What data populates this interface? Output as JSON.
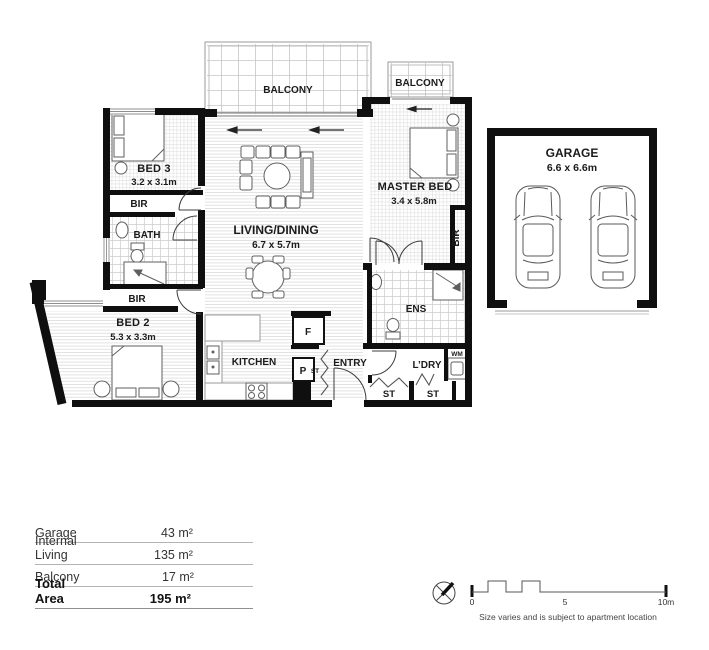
{
  "plan": {
    "balcony_main": {
      "label": "BALCONY"
    },
    "balcony_small": {
      "label": "BALCONY"
    },
    "bed3": {
      "label": "BED 3",
      "dims": "3.2 x 3.1m"
    },
    "bir_bed3": {
      "label": "BIR"
    },
    "bath": {
      "label": "BATH"
    },
    "bir_bed2": {
      "label": "BIR"
    },
    "bed2": {
      "label": "BED 2",
      "dims": "5.3 x 3.3m"
    },
    "living": {
      "label": "LIVING/DINING",
      "dims": "6.7 x 5.7m"
    },
    "kitchen": {
      "label": "KITCHEN"
    },
    "fridge": {
      "label": "F"
    },
    "pantry": {
      "label": "P"
    },
    "store_kitchen": {
      "label": "ST"
    },
    "entry": {
      "label": "ENTRY"
    },
    "master": {
      "label": "MASTER BED",
      "dims": "3.4 x 5.8m"
    },
    "bir_master": {
      "label": "BIR"
    },
    "ens": {
      "label": "ENS"
    },
    "laundry": {
      "label": "L’DRY"
    },
    "wm": {
      "label": "WM"
    },
    "store1": {
      "label": "ST"
    },
    "store2": {
      "label": "ST"
    },
    "garage": {
      "label": "GARAGE",
      "dims": "6.6 x 6.6m"
    }
  },
  "areas": {
    "rows": [
      {
        "label": "Garage",
        "value": "43 m²"
      },
      {
        "label": "Internal Living",
        "value": "135 m²"
      },
      {
        "label": "Balcony",
        "value": "17 m²"
      }
    ],
    "total": {
      "label": "Total Area",
      "value": "195 m²"
    }
  },
  "scale": {
    "tick0": "0",
    "tick5": "5",
    "tick10": "10m",
    "caption": "Size varies and is subject to apartment location"
  },
  "colors": {
    "wall": "#0f0f0f"
  }
}
